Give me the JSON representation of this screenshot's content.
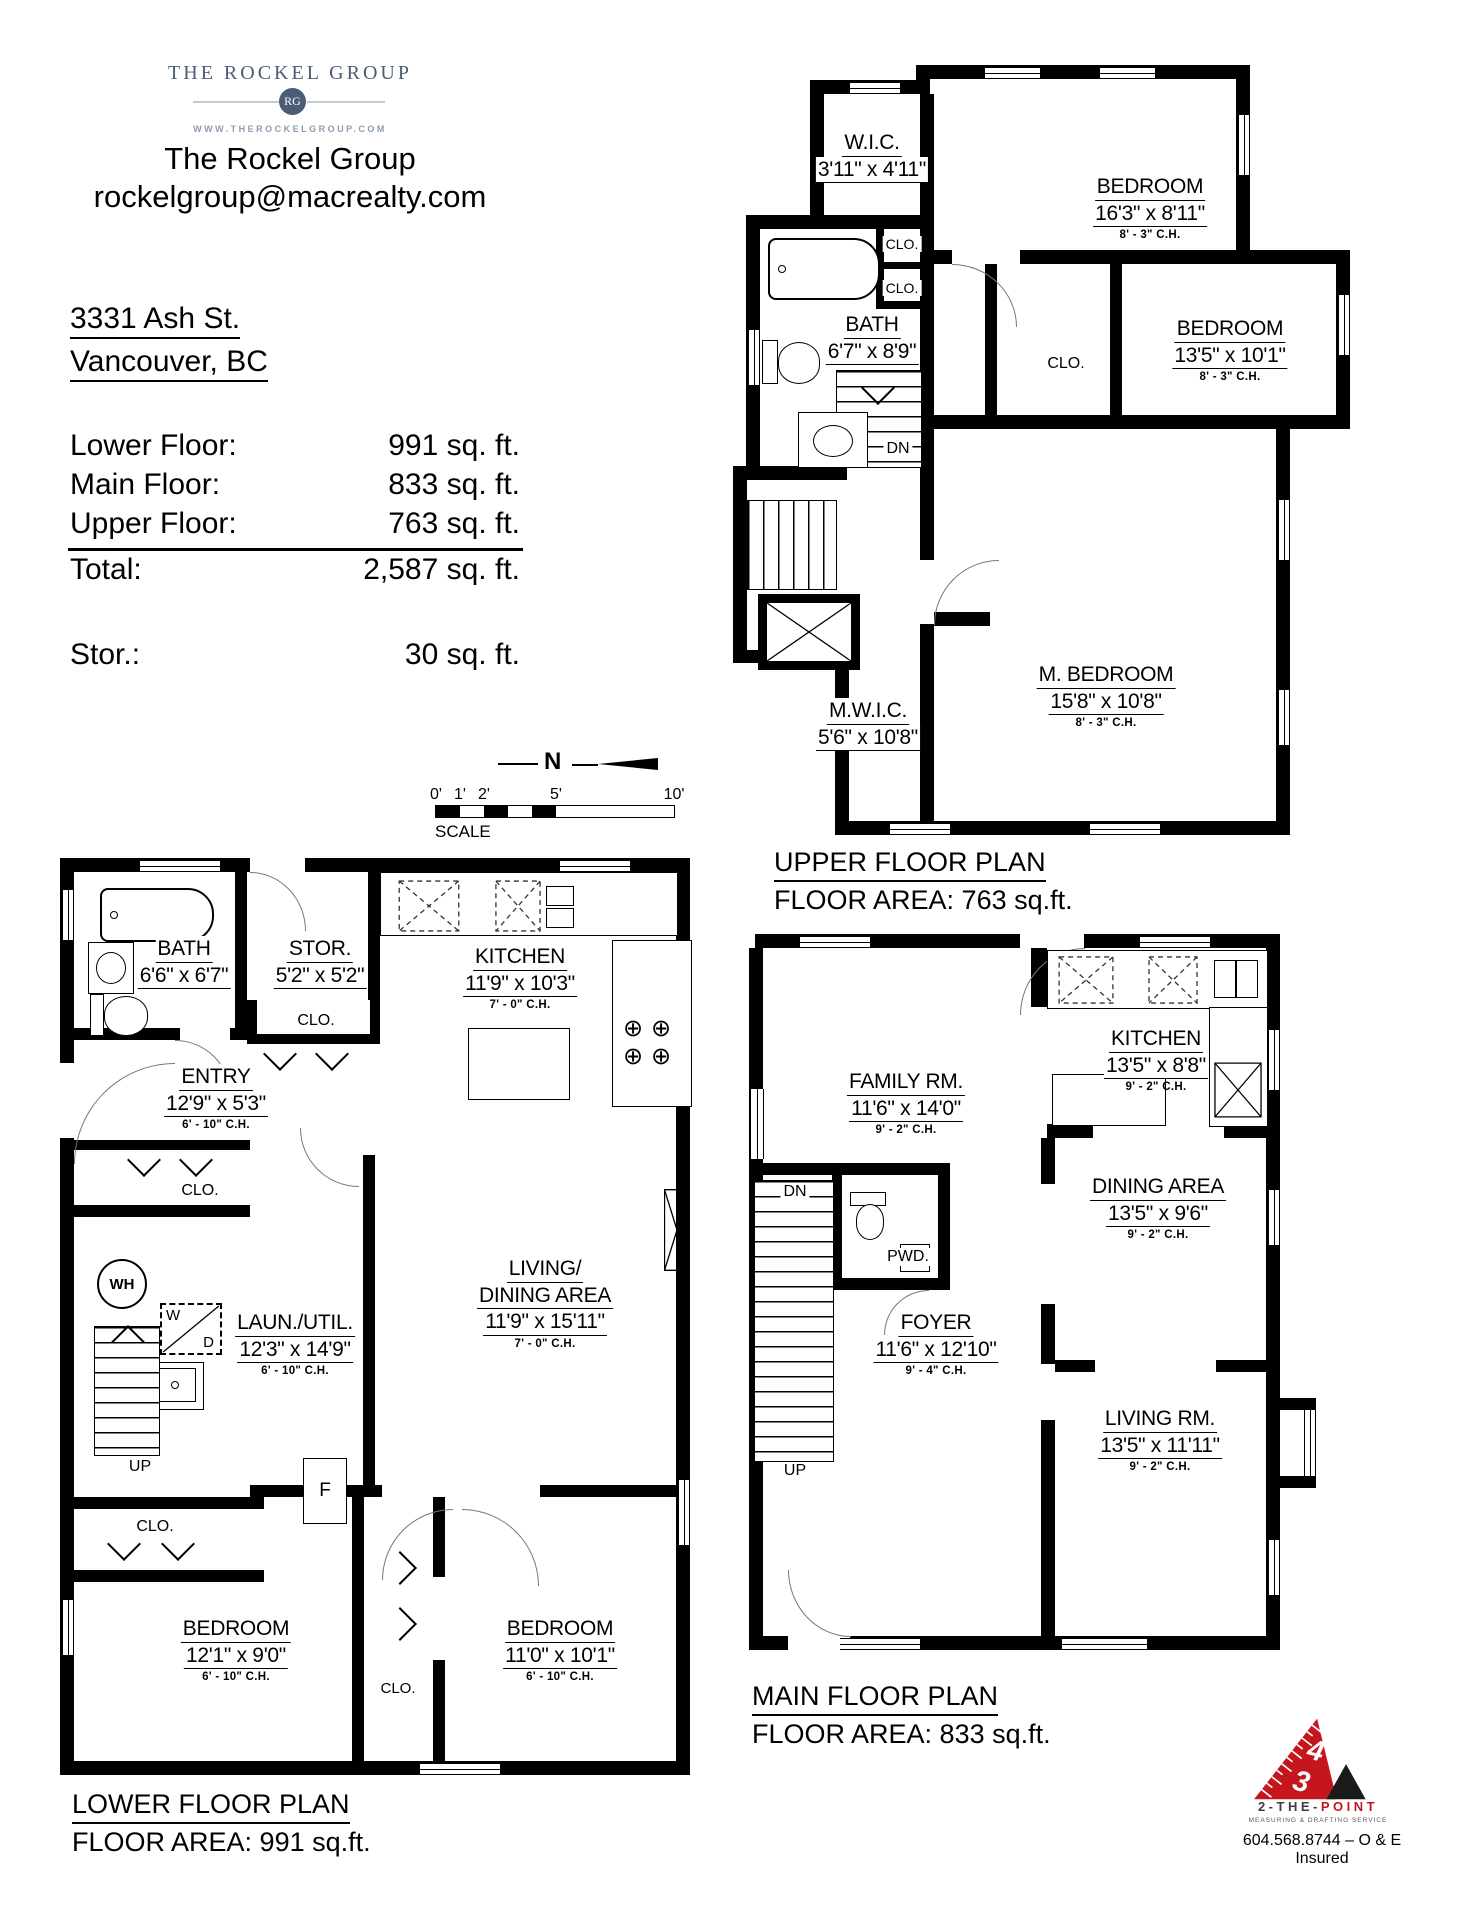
{
  "header": {
    "logo": {
      "brand": "THE ROCKEL GROUP",
      "monogram": "RG",
      "website": "WWW.THEROCKELGROUP.COM",
      "brand_color": "#4c5b76"
    },
    "company": "The Rockel Group",
    "email": "rockelgroup@macrealty.com"
  },
  "property": {
    "address_line1": "3331 Ash St.",
    "address_line2": "Vancouver, BC"
  },
  "areas": {
    "rows": [
      {
        "label": "Lower Floor:",
        "value": "991 sq. ft."
      },
      {
        "label": "Main Floor:",
        "value": "833 sq. ft."
      },
      {
        "label": "Upper Floor:",
        "value": "763 sq. ft."
      },
      {
        "label": "Total:",
        "value": "2,587 sq. ft."
      }
    ],
    "storage": {
      "label": "Stor.:",
      "value": "30 sq. ft."
    }
  },
  "scale_bar": {
    "ticks": [
      "0'",
      "1'",
      "2'",
      "5'",
      "10'"
    ],
    "label": "SCALE",
    "north": "N"
  },
  "labels": {
    "clo": "CLO.",
    "dn": "DN",
    "up": "UP",
    "wh": "WH",
    "washer": "W",
    "dryer": "D",
    "freezer": "F",
    "pwd": "PWD."
  },
  "icons": {
    "burner": "⊕"
  },
  "plans": {
    "upper": {
      "title": "UPPER FLOOR PLAN",
      "area": "FLOOR AREA: 763 sq.ft.",
      "rooms": {
        "wic": {
          "name": "W.I.C.",
          "dims": "3'11\" x 4'11\""
        },
        "bedroom1": {
          "name": "BEDROOM",
          "dims": "16'3\" x 8'11\"",
          "ch": "8' - 3\" C.H."
        },
        "bath": {
          "name": "BATH",
          "dims": "6'7\" x 8'9\""
        },
        "bedroom2": {
          "name": "BEDROOM",
          "dims": "13'5\" x 10'1\"",
          "ch": "8' - 3\" C.H."
        },
        "mwic": {
          "name": "M.W.I.C.",
          "dims": "5'6\" x 10'8\""
        },
        "mbedroom": {
          "name": "M. BEDROOM",
          "dims": "15'8\" x 10'8\"",
          "ch": "8' - 3\" C.H."
        }
      }
    },
    "main": {
      "title": "MAIN FLOOR PLAN",
      "area": "FLOOR AREA: 833 sq.ft.",
      "rooms": {
        "kitchen": {
          "name": "KITCHEN",
          "dims": "13'5\" x 8'8\"",
          "ch": "9' - 2\" C.H."
        },
        "family": {
          "name": "FAMILY RM.",
          "dims": "11'6\" x 14'0\"",
          "ch": "9' - 2\" C.H."
        },
        "dining": {
          "name": "DINING AREA",
          "dims": "13'5\" x 9'6\"",
          "ch": "9' - 2\" C.H."
        },
        "foyer": {
          "name": "FOYER",
          "dims": "11'6\" x 12'10\"",
          "ch": "9' - 4\" C.H."
        },
        "living": {
          "name": "LIVING RM.",
          "dims": "13'5\" x 11'11\"",
          "ch": "9' - 2\" C.H."
        },
        "pwd": {
          "name": "PWD."
        }
      }
    },
    "lower": {
      "title": "LOWER FLOOR PLAN",
      "area": "FLOOR AREA: 991 sq.ft.",
      "rooms": {
        "bath": {
          "name": "BATH",
          "dims": "6'6\" x 6'7\""
        },
        "stor": {
          "name": "STOR.",
          "dims": "5'2\" x 5'2\""
        },
        "kitchen": {
          "name": "KITCHEN",
          "dims": "11'9\" x 10'3\"",
          "ch": "7' - 0\" C.H."
        },
        "entry": {
          "name": "ENTRY",
          "dims": "12'9\" x 5'3\"",
          "ch": "6' - 10\" C.H."
        },
        "laun": {
          "name": "LAUN./UTIL.",
          "dims": "12'3\" x 14'9\"",
          "ch": "6' - 10\" C.H."
        },
        "livingdining": {
          "name1": "LIVING/",
          "name2": "DINING AREA",
          "dims": "11'9\" x 15'11\"",
          "ch": "7' - 0\" C.H."
        },
        "bedroom1": {
          "name": "BEDROOM",
          "dims": "12'1\" x 9'0\"",
          "ch": "6' - 10\" C.H."
        },
        "bedroom2": {
          "name": "BEDROOM",
          "dims": "11'0\" x 10'1\"",
          "ch": "6' - 10\" C.H."
        }
      }
    }
  },
  "footer": {
    "brand_prefix": "2-THE-",
    "brand_accent": "POINT",
    "tagline": "MEASURING & DRAFTING SERVICE",
    "phone": "604.568.8744 – O & E Insured",
    "ruler_numbers": {
      "four": "4",
      "three": "3"
    },
    "accent_color": "#c4161c"
  }
}
